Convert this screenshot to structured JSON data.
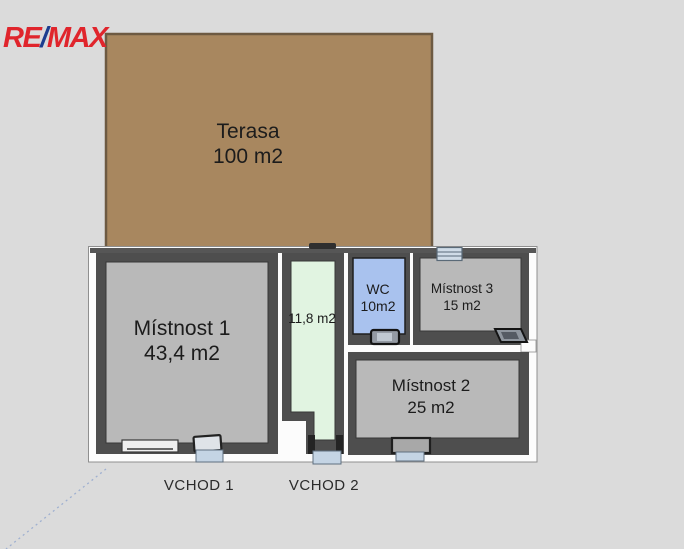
{
  "logo": {
    "part1": "RE",
    "slash": "/",
    "part2": "MAX"
  },
  "terrace": {
    "name": "Terasa",
    "area": "100 m2"
  },
  "rooms": {
    "room1": {
      "name": "Místnost 1",
      "area": "43,4 m2"
    },
    "corridor": {
      "area": "11,8 m2"
    },
    "wc": {
      "name": "WC",
      "area": "10m2"
    },
    "room3": {
      "name": "Místnost 3",
      "area": "15 m2"
    },
    "room2": {
      "name": "Místnost 2",
      "area": "25 m2"
    }
  },
  "entrances": {
    "entrance1": "VCHOD 1",
    "entrance2": "VCHOD 2"
  },
  "colors": {
    "background": "#dbdbdb",
    "terrace_fill": "#a8875f",
    "terrace_border": "#6d5a42",
    "wall_dark": "#4e4e4e",
    "wall_white": "#fcfcfc",
    "room_gray": "#b9b9b9",
    "corridor_green": "#e1f4e1",
    "wc_blue": "#a9c2ee",
    "door_sill_blue": "#c4d4e4",
    "logo_red": "#e0252c",
    "logo_blue": "#1b3d8f"
  }
}
